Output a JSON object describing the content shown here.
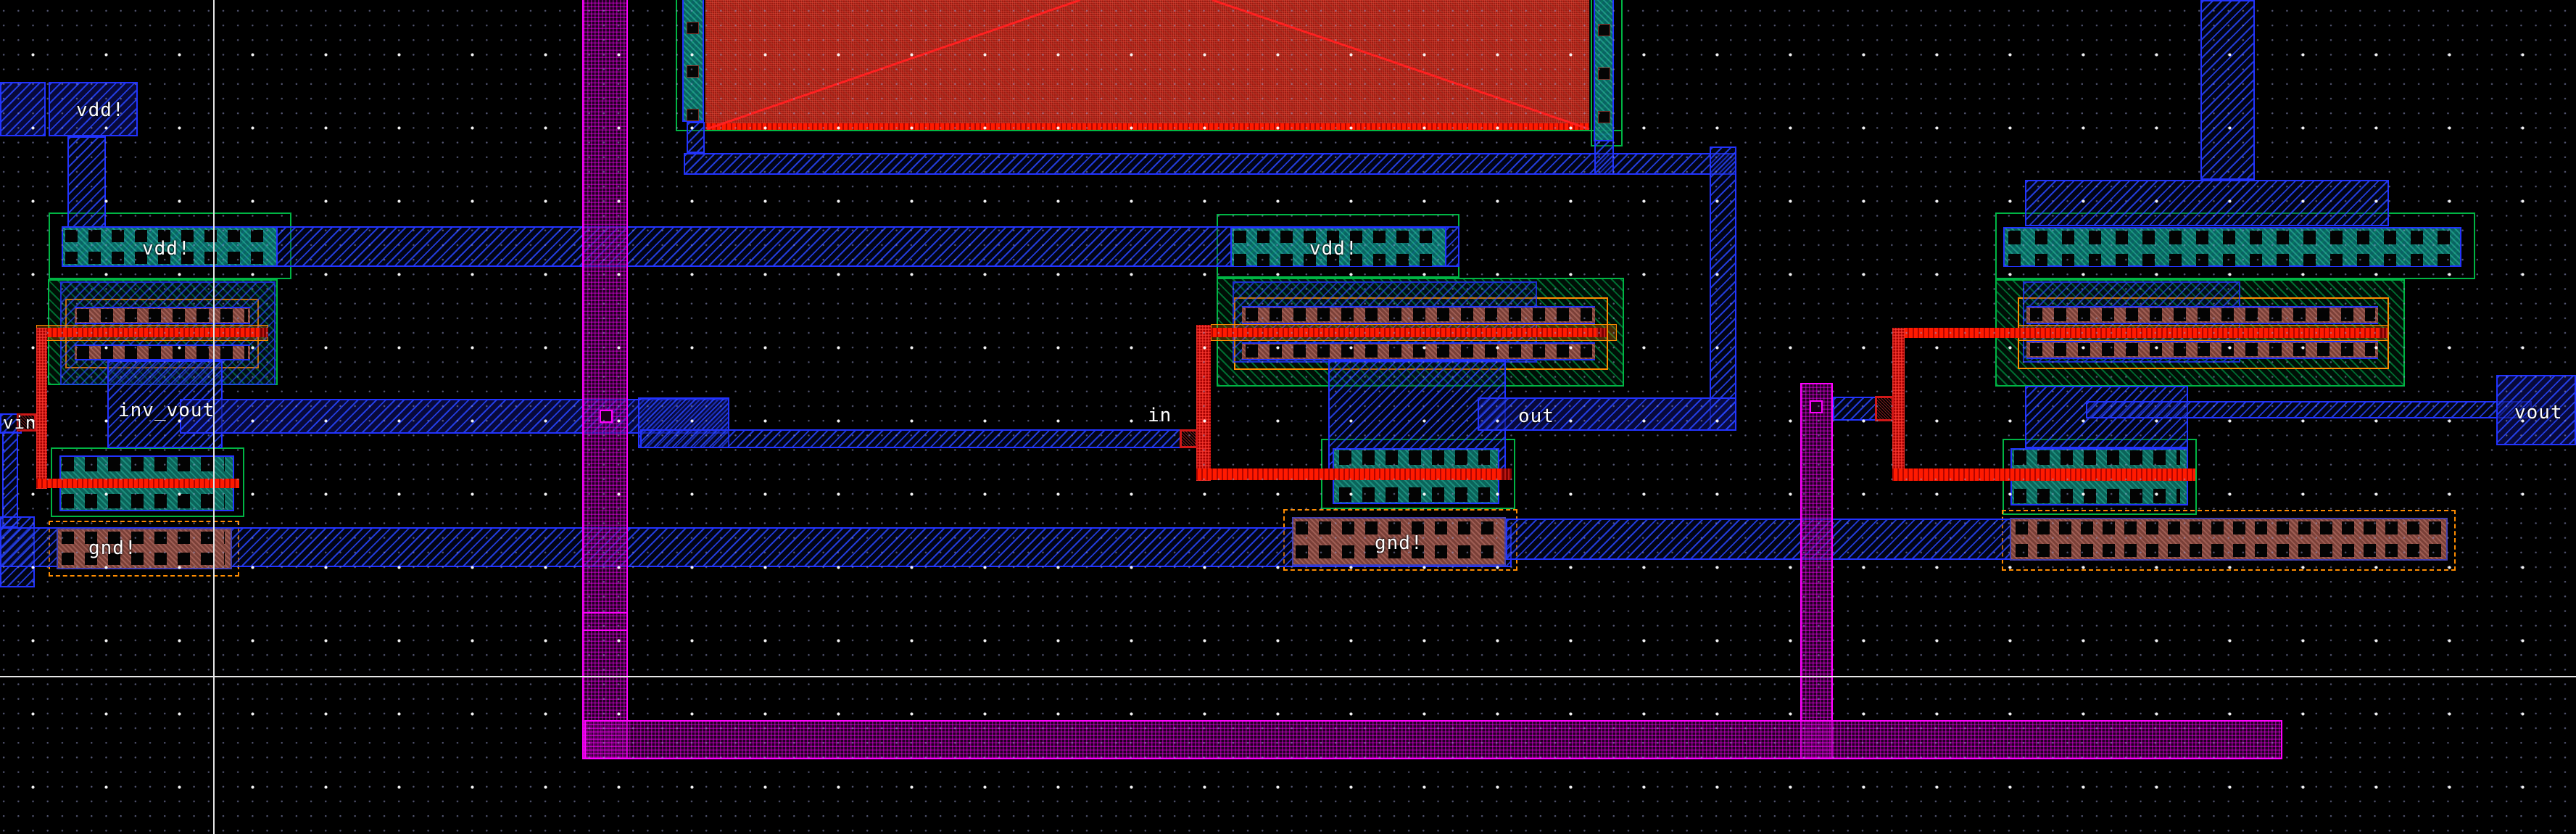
{
  "editor": {
    "view": "ic-layout-canvas"
  },
  "labels": {
    "vdd_top": "vdd!",
    "vdd_left_tap": "vdd!",
    "vdd_mid_tap": "vdd!",
    "vin": "vin",
    "inv_vout": "inv_vout",
    "gnd_left": "gnd!",
    "in_pin": "in",
    "out_pin": "out",
    "gnd_mid": "gnd!",
    "vout": "vout"
  },
  "colors": {
    "m1": "#2233ff",
    "m2": "#ff00ff",
    "poly": "#ff1a00",
    "nwell": "#00b544",
    "orange": "#ff8c00",
    "cap": "#9e1b12",
    "txt": "#ffffff",
    "cross": "#e6e6e6",
    "gmaj": "rgba(255,255,255,0.95)",
    "gmin": "rgba(150,155,205,0.55)"
  }
}
